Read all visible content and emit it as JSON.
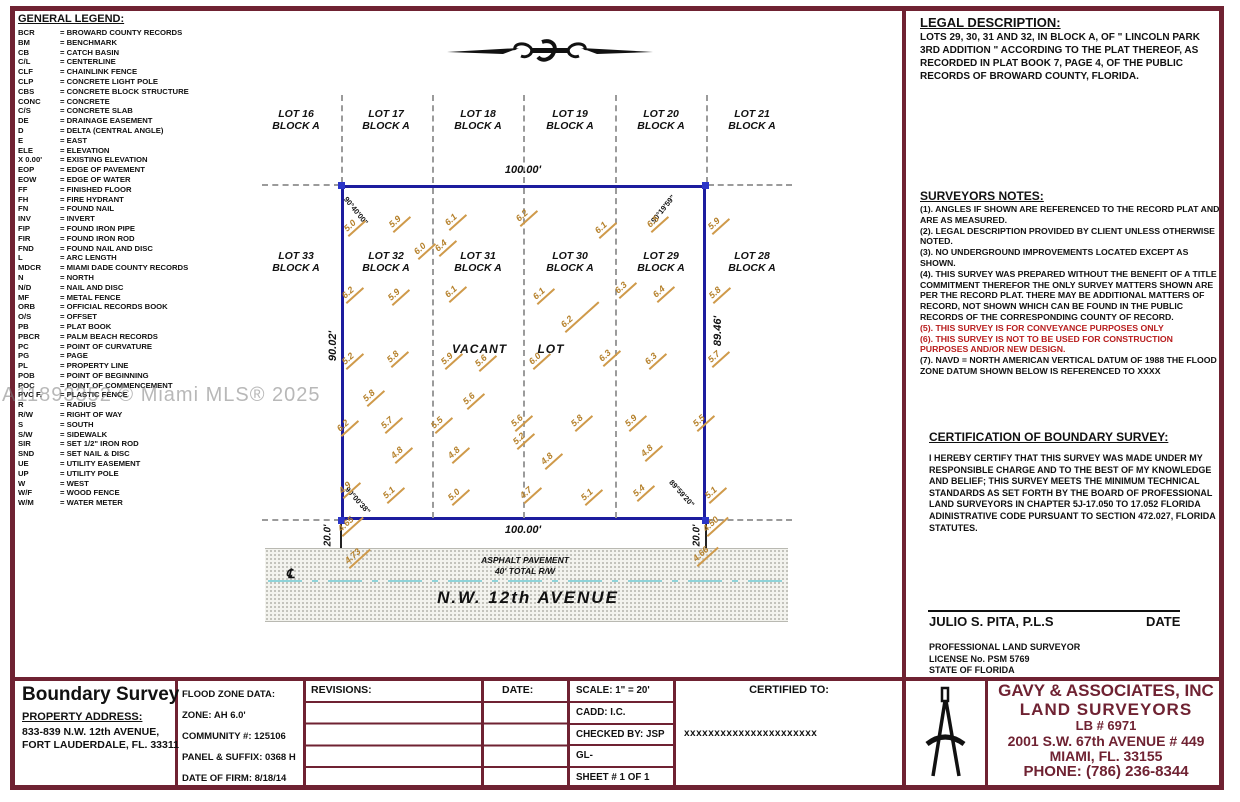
{
  "watermark": "A11893352 © Miami MLS® 2025",
  "legend": {
    "title": "GENERAL LEGEND:",
    "items": [
      {
        "abbr": "BCR",
        "def": "= BROWARD COUNTY RECORDS"
      },
      {
        "abbr": "BM",
        "def": "= BENCHMARK"
      },
      {
        "abbr": "CB",
        "def": "= CATCH BASIN"
      },
      {
        "abbr": "C/L",
        "def": "= CENTERLINE"
      },
      {
        "abbr": "CLF",
        "def": "= CHAINLINK FENCE"
      },
      {
        "abbr": "CLP",
        "def": "= CONCRETE LIGHT POLE"
      },
      {
        "abbr": "CBS",
        "def": "= CONCRETE BLOCK STRUCTURE"
      },
      {
        "abbr": "CONC",
        "def": "= CONCRETE"
      },
      {
        "abbr": "C/S",
        "def": "= CONCRETE SLAB"
      },
      {
        "abbr": "DE",
        "def": "= DRAINAGE EASEMENT"
      },
      {
        "abbr": "D",
        "def": "= DELTA (CENTRAL ANGLE)"
      },
      {
        "abbr": "E",
        "def": "= EAST"
      },
      {
        "abbr": "ELE",
        "def": "= ELEVATION"
      },
      {
        "abbr": "X 0.00'",
        "def": "= EXISTING ELEVATION"
      },
      {
        "abbr": "EOP",
        "def": "= EDGE OF PAVEMENT"
      },
      {
        "abbr": "EOW",
        "def": "= EDGE OF WATER"
      },
      {
        "abbr": "FF",
        "def": "= FINISHED FLOOR"
      },
      {
        "abbr": "FH",
        "def": "= FIRE HYDRANT"
      },
      {
        "abbr": "FN",
        "def": "= FOUND NAIL"
      },
      {
        "abbr": "INV",
        "def": "= INVERT"
      },
      {
        "abbr": "FIP",
        "def": "= FOUND IRON PIPE"
      },
      {
        "abbr": "FIR",
        "def": "= FOUND IRON ROD"
      },
      {
        "abbr": "FND",
        "def": "= FOUND NAIL AND DISC"
      },
      {
        "abbr": "L",
        "def": "= ARC LENGTH"
      },
      {
        "abbr": "MDCR",
        "def": "= MIAMI DADE COUNTY RECORDS"
      },
      {
        "abbr": "N",
        "def": "= NORTH"
      },
      {
        "abbr": "N/D",
        "def": "= NAIL AND DISC"
      },
      {
        "abbr": "MF",
        "def": "= METAL FENCE"
      },
      {
        "abbr": "ORB",
        "def": "= OFFICIAL RECORDS BOOK"
      },
      {
        "abbr": "O/S",
        "def": "= OFFSET"
      },
      {
        "abbr": "PB",
        "def": "= PLAT BOOK"
      },
      {
        "abbr": "PBCR",
        "def": "= PALM BEACH RECORDS"
      },
      {
        "abbr": "PC",
        "def": "= POINT OF CURVATURE"
      },
      {
        "abbr": "PG",
        "def": "= PAGE"
      },
      {
        "abbr": "PL",
        "def": "= PROPERTY LINE"
      },
      {
        "abbr": "POB",
        "def": "= POINT OF BEGINNING"
      },
      {
        "abbr": "POC",
        "def": "= POINT OF COMMENCEMENT"
      },
      {
        "abbr": "PVC F.",
        "def": "= PLASTIC FENCE"
      },
      {
        "abbr": "R",
        "def": "= RADIUS"
      },
      {
        "abbr": "R/W",
        "def": "= RIGHT OF WAY"
      },
      {
        "abbr": "S",
        "def": "= SOUTH"
      },
      {
        "abbr": "S/W",
        "def": "= SIDEWALK"
      },
      {
        "abbr": "SIR",
        "def": "= SET 1/2\" IRON ROD"
      },
      {
        "abbr": "SND",
        "def": "= SET NAIL & DISC"
      },
      {
        "abbr": "UE",
        "def": "= UTILITY EASEMENT"
      },
      {
        "abbr": "UP",
        "def": "= UTILITY POLE"
      },
      {
        "abbr": "W",
        "def": "= WEST"
      },
      {
        "abbr": "W/F",
        "def": "= WOOD FENCE"
      },
      {
        "abbr": "W/M",
        "def": "= WATER METER"
      }
    ]
  },
  "legal": {
    "title": "LEGAL DESCRIPTION:",
    "body": "LOTS 29, 30, 31 AND 32, IN BLOCK A, OF \" LINCOLN PARK 3RD ADDITION \" ACCORDING TO THE PLAT THEREOF, AS RECORDED IN PLAT BOOK 7, PAGE 4, OF THE PUBLIC RECORDS OF BROWARD COUNTY, FLORIDA."
  },
  "notes": {
    "title": "SURVEYORS NOTES:",
    "items": [
      {
        "text": "(1).  ANGLES IF SHOWN ARE REFERENCED TO THE RECORD PLAT AND ARE AS MEASURED.",
        "red": false
      },
      {
        "text": "(2).  LEGAL DESCRIPTION PROVIDED BY CLIENT UNLESS OTHERWISE NOTED.",
        "red": false
      },
      {
        "text": "(3).  NO UNDERGROUND IMPROVEMENTS LOCATED EXCEPT AS SHOWN.",
        "red": false
      },
      {
        "text": "(4). THIS SURVEY WAS PREPARED WITHOUT THE BENEFIT OF A TITLE COMMITMENT THEREFOR THE ONLY SURVEY MATTERS SHOWN ARE PER THE RECORD PLAT. THERE MAY BE ADDITIONAL MATTERS OF RECORD, NOT SHOWN WHICH CAN BE FOUND IN THE PUBLIC RECORDS OF THE CORRESPONDING COUNTY OF RECORD.",
        "red": false
      },
      {
        "text": "(5).  THIS SURVEY IS FOR CONVEYANCE PURPOSES ONLY",
        "red": true
      },
      {
        "text": "(6).  THIS SURVEY IS NOT TO BE USED FOR CONSTRUCTION PURPOSES AND/OR NEW DESIGN.",
        "red": true
      },
      {
        "text": "(7).  NAVD = NORTH AMERICAN VERTICAL DATUM OF 1988 THE FLOOD ZONE DATUM SHOWN BELOW IS REFERENCED TO XXXX",
        "red": false
      }
    ]
  },
  "certification": {
    "title": "CERTIFICATION OF BOUNDARY SURVEY:",
    "body": "I HEREBY CERTIFY THAT THIS SURVEY WAS MADE UNDER MY RESPONSIBLE CHARGE AND TO THE BEST OF MY KNOWLEDGE AND BELIEF; THIS SURVEY MEETS THE MINIMUM TECHNICAL STANDARDS AS SET FORTH BY THE BOARD OF PROFESSIONAL LAND SURVEYORS IN CHAPTER 5J-17.050 TO 17.052 FLORIDA ADINISTRATIVE CODE PURSUANT TO SECTION 472.027, FLORIDA STATUTES.",
    "signer": "JULIO S. PITA, P.L.S",
    "date_label": "DATE",
    "signer_lines": [
      "PROFESSIONAL LAND SURVEYOR",
      "LICENSE No. PSM 5769",
      "STATE OF FLORIDA"
    ]
  },
  "drawing": {
    "dims": {
      "top": "100.00'",
      "bottom": "100.00'",
      "left": "90.02'",
      "right": "89.46'",
      "offset_left": "20.0'",
      "offset_right": "20.0'"
    },
    "angles": {
      "tl": "90°40'00\"",
      "tr": "90°19'59\"",
      "bl": "90°00'38\"",
      "br": "89°59'20\""
    },
    "vacant_label": "VACANT LOT",
    "street": {
      "cl_symbol": "℄",
      "pavement": "ASPHALT PAVEMENT",
      "total_rw": "40' TOTAL R/W",
      "name": "N.W. 12th AVENUE"
    },
    "top_lots": [
      {
        "lot": "LOT 16",
        "block": "BLOCK A",
        "x": 296
      },
      {
        "lot": "LOT 17",
        "block": "BLOCK A",
        "x": 386
      },
      {
        "lot": "LOT 18",
        "block": "BLOCK A",
        "x": 478
      },
      {
        "lot": "LOT 19",
        "block": "BLOCK A",
        "x": 570
      },
      {
        "lot": "LOT 20",
        "block": "BLOCK A",
        "x": 661
      },
      {
        "lot": "LOT 21",
        "block": "BLOCK A",
        "x": 752
      }
    ],
    "mid_lots": [
      {
        "lot": "LOT 33",
        "block": "BLOCK A",
        "x": 296
      },
      {
        "lot": "LOT 32",
        "block": "BLOCK A",
        "x": 386
      },
      {
        "lot": "LOT 31",
        "block": "BLOCK A",
        "x": 478
      },
      {
        "lot": "LOT 30",
        "block": "BLOCK A",
        "x": 570
      },
      {
        "lot": "LOT 29",
        "block": "BLOCK A",
        "x": 661
      },
      {
        "lot": "LOT 28",
        "block": "BLOCK A",
        "x": 752
      }
    ],
    "spots": [
      {
        "v": "5.0",
        "x": 349,
        "y": 224
      },
      {
        "v": "5.9",
        "x": 394,
        "y": 220
      },
      {
        "v": "6.1",
        "x": 450,
        "y": 218
      },
      {
        "v": "6.2",
        "x": 521,
        "y": 214
      },
      {
        "v": "6.0",
        "x": 419,
        "y": 247
      },
      {
        "v": "6.4",
        "x": 440,
        "y": 244
      },
      {
        "v": "6.1",
        "x": 600,
        "y": 226
      },
      {
        "v": "6.5",
        "x": 652,
        "y": 220
      },
      {
        "v": "5.9",
        "x": 713,
        "y": 222
      },
      {
        "v": "6.2",
        "x": 347,
        "y": 291
      },
      {
        "v": "5.9",
        "x": 393,
        "y": 293
      },
      {
        "v": "6.1",
        "x": 450,
        "y": 290
      },
      {
        "v": "6.1",
        "x": 538,
        "y": 292
      },
      {
        "v": "6.3",
        "x": 620,
        "y": 286
      },
      {
        "v": "6.4",
        "x": 658,
        "y": 290
      },
      {
        "v": "5.8",
        "x": 714,
        "y": 291
      },
      {
        "v": "6.2",
        "x": 566,
        "y": 320,
        "w": 30
      },
      {
        "v": "5.2",
        "x": 347,
        "y": 357
      },
      {
        "v": "5.8",
        "x": 392,
        "y": 355
      },
      {
        "v": "5.9",
        "x": 446,
        "y": 357
      },
      {
        "v": "5.6",
        "x": 480,
        "y": 359
      },
      {
        "v": "6.0",
        "x": 534,
        "y": 357
      },
      {
        "v": "6.3",
        "x": 604,
        "y": 354
      },
      {
        "v": "6.3",
        "x": 650,
        "y": 357
      },
      {
        "v": "5.7",
        "x": 713,
        "y": 355
      },
      {
        "v": "5.8",
        "x": 368,
        "y": 394
      },
      {
        "v": "5.6",
        "x": 468,
        "y": 397
      },
      {
        "v": "6.2",
        "x": 342,
        "y": 424
      },
      {
        "v": "5.7",
        "x": 386,
        "y": 421
      },
      {
        "v": "5.5",
        "x": 436,
        "y": 421
      },
      {
        "v": "5.6",
        "x": 516,
        "y": 419
      },
      {
        "v": "5.2",
        "x": 518,
        "y": 437
      },
      {
        "v": "5.8",
        "x": 576,
        "y": 419
      },
      {
        "v": "5.9",
        "x": 630,
        "y": 419
      },
      {
        "v": "5.5",
        "x": 698,
        "y": 419
      },
      {
        "v": "4.8",
        "x": 396,
        "y": 451
      },
      {
        "v": "4.8",
        "x": 453,
        "y": 451
      },
      {
        "v": "4.8",
        "x": 546,
        "y": 457
      },
      {
        "v": "4.8",
        "x": 646,
        "y": 449
      },
      {
        "v": "4.9",
        "x": 344,
        "y": 486
      },
      {
        "v": "5.1",
        "x": 388,
        "y": 491
      },
      {
        "v": "5.0",
        "x": 453,
        "y": 493
      },
      {
        "v": "4.7",
        "x": 525,
        "y": 491
      },
      {
        "v": "5.1",
        "x": 586,
        "y": 493
      },
      {
        "v": "5.4",
        "x": 638,
        "y": 489
      },
      {
        "v": "5.1",
        "x": 710,
        "y": 491
      },
      {
        "v": "4.65",
        "x": 343,
        "y": 524
      },
      {
        "v": "4.50",
        "x": 708,
        "y": 524
      },
      {
        "v": "4.73",
        "x": 350,
        "y": 556
      },
      {
        "v": "4.66",
        "x": 698,
        "y": 554
      }
    ]
  },
  "titleblock": {
    "title": "Boundary Survey",
    "address_label": "PROPERTY ADDRESS:",
    "address1": "833-839 N.W. 12th AVENUE,",
    "address2": "FORT LAUDERDALE, FL. 33311",
    "flood": [
      "FLOOD ZONE DATA:",
      "ZONE:  AH  6.0'",
      "COMMUNITY #: 125106",
      "PANEL & SUFFIX: 0368 H",
      "DATE OF FIRM: 8/18/14"
    ],
    "revisions_label": "REVISIONS:",
    "date_label": "DATE:",
    "scale_rows": [
      "SCALE:   1\" = 20'",
      "CADD:   I.C.",
      "CHECKED BY: JSP",
      "GL-",
      "SHEET #  1  OF  1"
    ],
    "certified_label": "CERTIFIED TO:",
    "certified_value": "xxxxxxxxxxxxxxxxxxxxxx",
    "company": [
      "GAVY & ASSOCIATES, INC",
      "LAND SURVEYORS",
      "LB # 6971",
      "2001 S.W. 67th AVENUE # 449",
      "MIAMI, FL. 33155",
      "PHONE: (786) 236-8344"
    ]
  }
}
